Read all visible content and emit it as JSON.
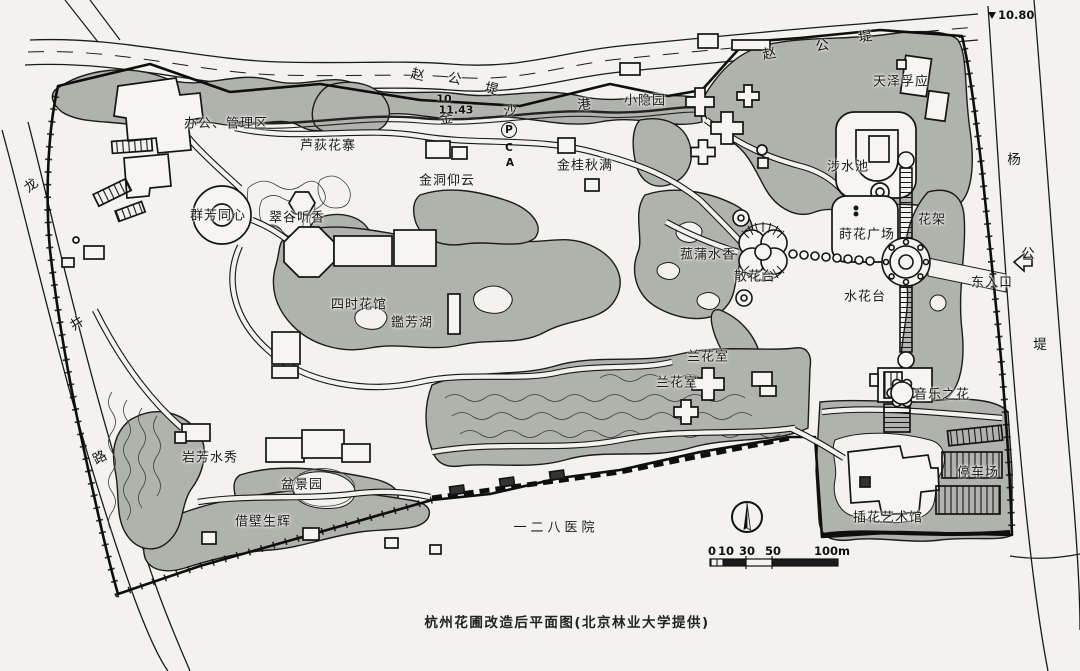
{
  "caption": "杭州花圃改造后平面图(北京林业大学提供)",
  "areas": {
    "bangong": "办公、管理区",
    "ludi": "芦荻花寨",
    "qunfang": "群芳同心",
    "cuigu": "翠谷听香",
    "jindong": "金洞仰云",
    "jingui": "金桂秋满",
    "xiaoyin": "小隐园",
    "tianze": "天泽孚应",
    "sheshui": "涉水池",
    "huajia": "花架",
    "shihua": "莳花广场",
    "gupu": "菰蒲水香",
    "sanhua": "散花台",
    "shuihua": "水花台",
    "dongrukou": "东入口",
    "yinyue": "音乐之花",
    "lanhua_a": "兰花室",
    "lanhua_b": "兰花室",
    "sishi": "四时花馆",
    "jianfang": "鑑芳湖",
    "yanfang": "岩芳水秀",
    "penjing": "盆景园",
    "jiebi": "借壁生辉",
    "yiyuan": "一二八医院",
    "tingche": "停车场",
    "chahua": "插花艺术馆"
  },
  "roads": {
    "zhao_gong_di_west": [
      "赵",
      "公",
      "堤"
    ],
    "zhao_gong_di_east": [
      "赵",
      "公",
      "堤"
    ],
    "long_jing_lu": [
      "龙",
      "井",
      "路"
    ],
    "yang_gong_di": [
      "杨",
      "公",
      "堤"
    ],
    "jin_sha_gang": [
      "金",
      "沙",
      "港"
    ]
  },
  "elevations": {
    "benchmark": "10.80",
    "spot_a": "10",
    "spot_b": "11.43"
  },
  "markers": {
    "p": "P",
    "c": "C",
    "a": "A"
  },
  "scale_bar": {
    "n0": "0",
    "n10": "10",
    "n30": "30",
    "n50": "50",
    "n100": "100m"
  }
}
